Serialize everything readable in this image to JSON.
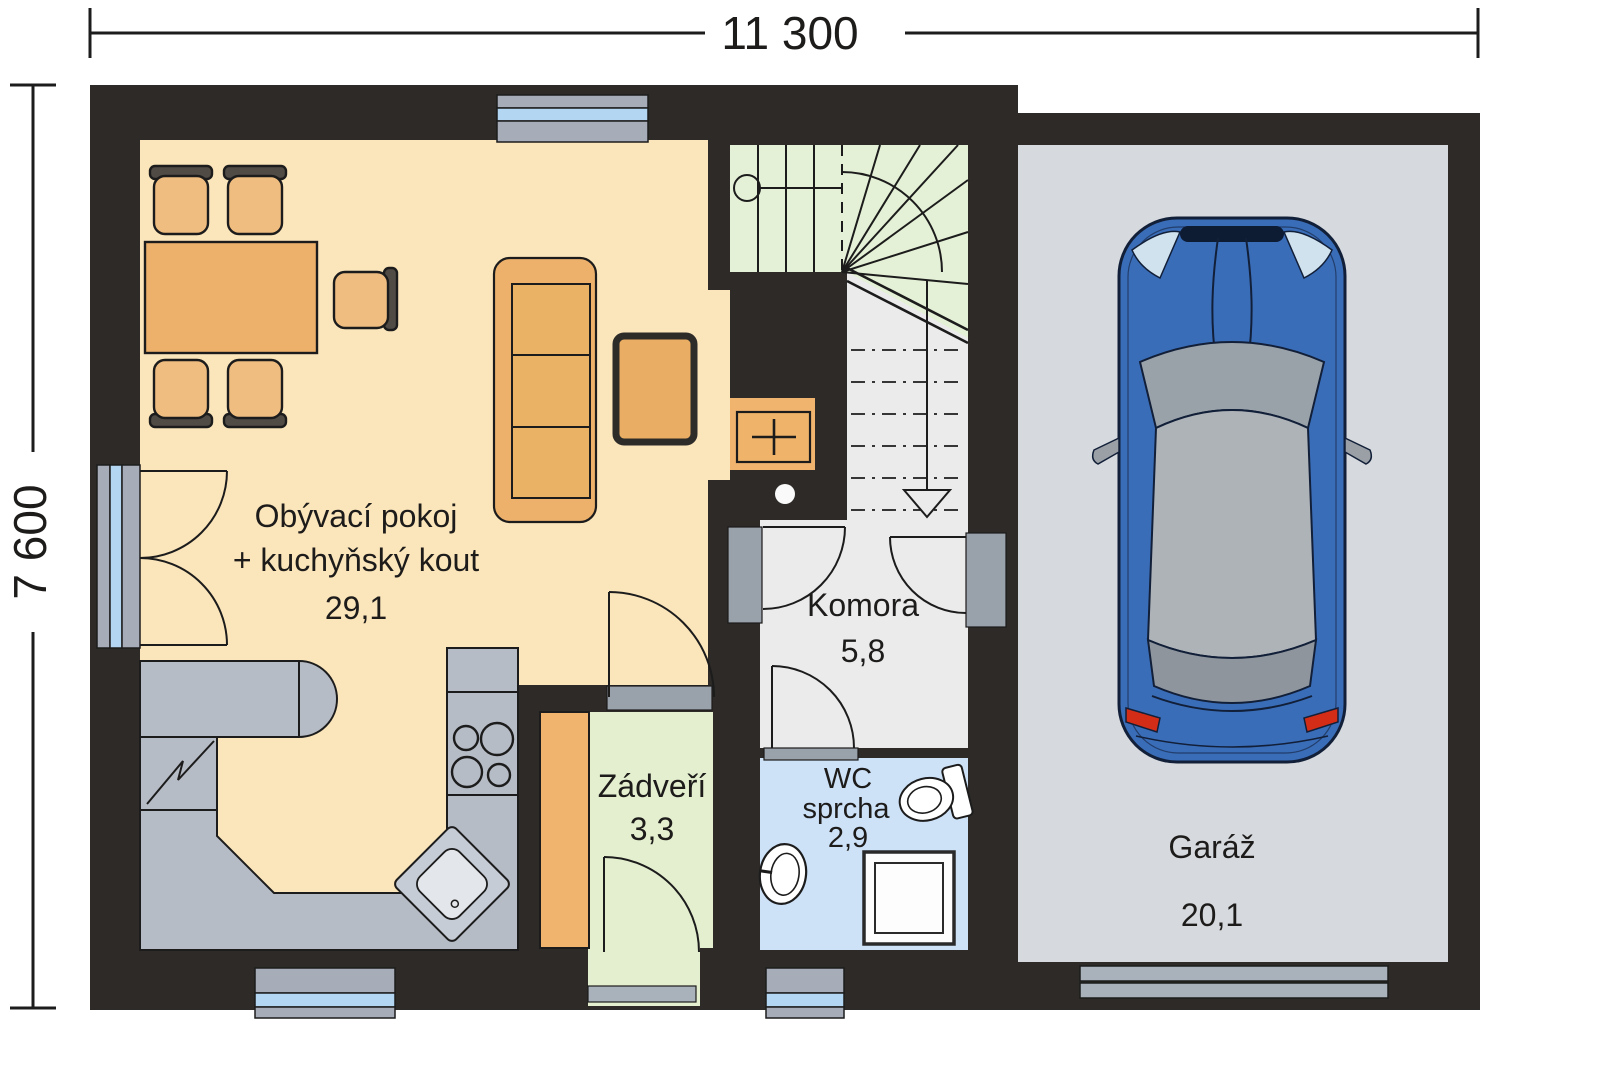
{
  "title": "House ground floor plan",
  "dimensions": {
    "width_label": "11 300",
    "height_label": "7 600"
  },
  "rooms": {
    "living": {
      "line1": "Obývací pokoj",
      "line2": "+ kuchyňský kout",
      "area": "29,1"
    },
    "komora": {
      "name": "Komora",
      "area": "5,8"
    },
    "zadveri": {
      "name": "Zádveří",
      "area": "3,3"
    },
    "wc": {
      "line1": "WC",
      "line2": "sprcha",
      "area": "2,9"
    },
    "garaz": {
      "name": "Garáž",
      "area": "20,1"
    }
  },
  "colors": {
    "wall": "#2d2a27",
    "living_floor": "#fbe5ba",
    "stairs_green": "#e4f1d6",
    "zadveri_green": "#e4efcf",
    "komora_floor": "#ebebec",
    "wc_blue": "#cde1f7",
    "garage_floor": "#d6d9dd",
    "furniture_orange": "#edb16b",
    "counter_gray": "#b6bcc6",
    "window_glass": "#b3d6f2",
    "window_frame": "#a6adb8",
    "car_blue": "#3a6db8",
    "taillight_red": "#d42d17",
    "line_dark": "#1c1c1c"
  }
}
